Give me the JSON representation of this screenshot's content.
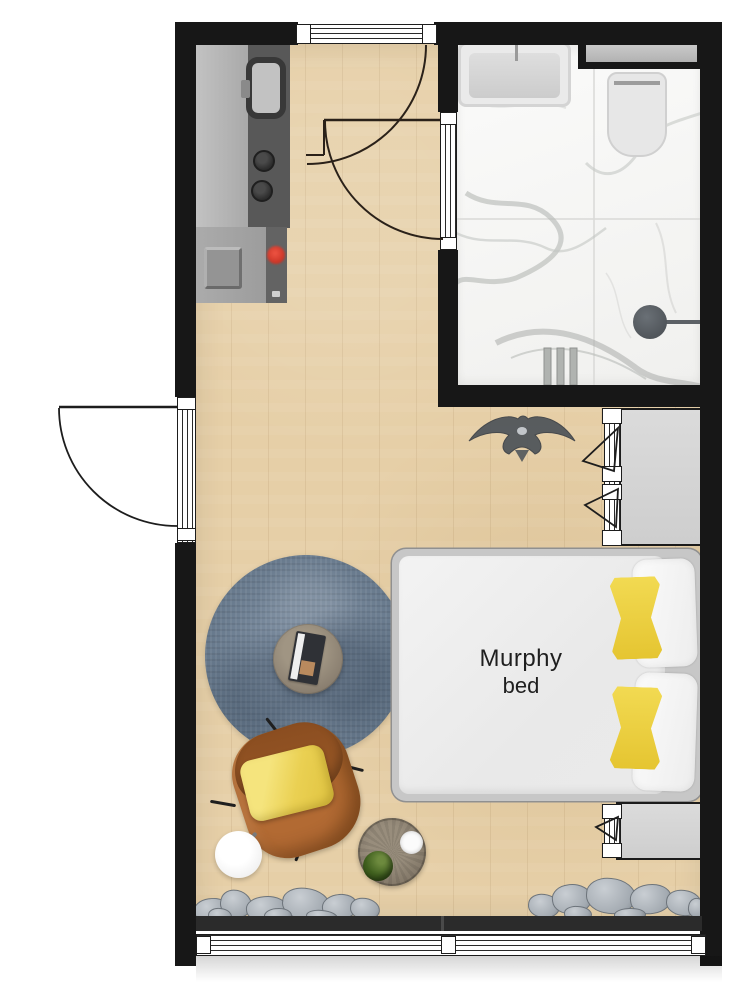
{
  "floorplan": {
    "bed_label": {
      "line1": "Murphy",
      "line2": "bed"
    }
  },
  "colors": {
    "wall": "#171717",
    "wood_floor": "#e6cfa7",
    "marble_floor": "#f0f0ee",
    "rug_blue": "#66788b",
    "chair_brown": "#a5622c",
    "pillow_yellow": "#e5c531",
    "mattress_white": "#e9e9e9",
    "counter_gray": "#a8a8a8",
    "counter_dark_gray": "#585858",
    "stone_gray": "#a3aab1",
    "stove_red": "#c93325",
    "plant_green": "#41611f",
    "fan_gray": "#51565b"
  },
  "furniture_icons": [
    "kitchen-counter",
    "kitchen-sink",
    "cooktop-burners",
    "bathtub",
    "toilet",
    "shower-head",
    "wall-niche",
    "wardrobe",
    "murphy-bed",
    "white-pillow",
    "yellow-pillow",
    "area-rug",
    "coffee-table",
    "magazine",
    "armchair",
    "floor-lamp",
    "side-table",
    "potted-plant",
    "bowl",
    "storage-bench",
    "ceiling-fan",
    "decorative-stones",
    "entry-door",
    "bathroom-door",
    "window"
  ]
}
